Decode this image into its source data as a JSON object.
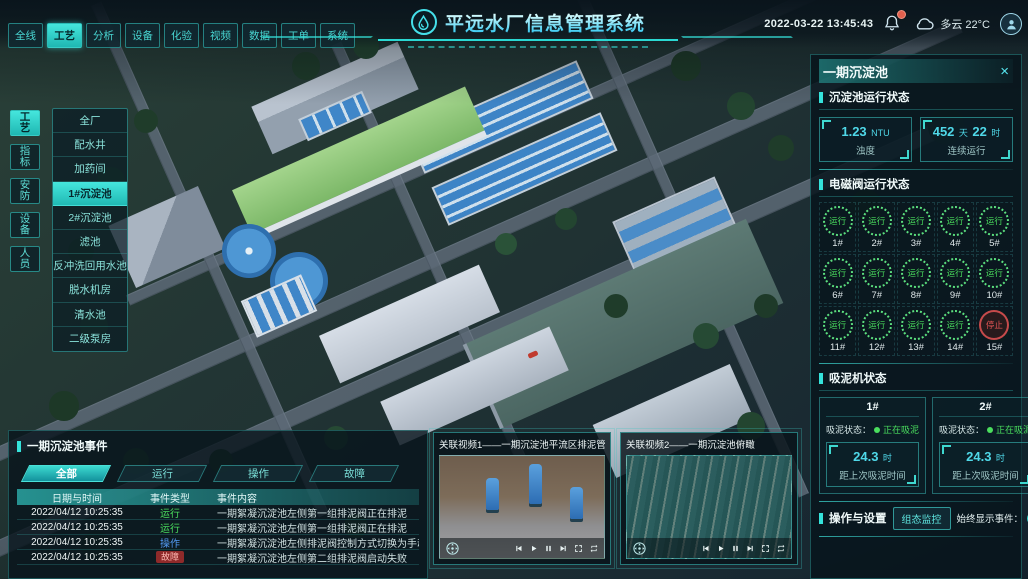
{
  "top_bar": {
    "title": "平远水厂信息管理系统",
    "datetime": "2022-03-22 13:45:43",
    "weather": "多云 22°C",
    "tabs": [
      {
        "label": "全线"
      },
      {
        "label": "工艺",
        "cls": "active"
      },
      {
        "label": "分析"
      },
      {
        "label": "设备"
      },
      {
        "label": "化验"
      },
      {
        "label": "视频"
      },
      {
        "label": "数据"
      },
      {
        "label": "工单"
      },
      {
        "label": "系统"
      }
    ]
  },
  "sidebar": {
    "tabs": [
      {
        "label": "工艺",
        "cls": "active"
      },
      {
        "label": "指标"
      },
      {
        "label": "安防"
      },
      {
        "label": "设备"
      },
      {
        "label": "人员"
      }
    ],
    "menu_items": [
      {
        "label": "全厂"
      },
      {
        "label": "配水井"
      },
      {
        "label": "加药间"
      },
      {
        "label": "1#沉淀池",
        "cls": "active"
      },
      {
        "label": "2#沉淀池"
      },
      {
        "label": "滤池"
      },
      {
        "label": "反冲洗回用水池"
      },
      {
        "label": "脱水机房"
      },
      {
        "label": "清水池"
      },
      {
        "label": "二级泵房"
      }
    ]
  },
  "right_panel": {
    "title": "一期沉淀池",
    "close": "×",
    "pool_status": {
      "title": "沉淀池运行状态",
      "stats": [
        {
          "value": "1.23",
          "unit": "NTU",
          "label": "浊度"
        },
        {
          "value": "452",
          "unit": "天",
          "value2": "22",
          "unit2": "时",
          "label": "连续运行"
        }
      ]
    },
    "valves": {
      "title": "电磁阀运行状态",
      "items": [
        {
          "id": "1#",
          "status": "运行",
          "cls": "run"
        },
        {
          "id": "2#",
          "status": "运行",
          "cls": "run"
        },
        {
          "id": "3#",
          "status": "运行",
          "cls": "run"
        },
        {
          "id": "4#",
          "status": "运行",
          "cls": "run"
        },
        {
          "id": "5#",
          "status": "运行",
          "cls": "run"
        },
        {
          "id": "6#",
          "status": "运行",
          "cls": "run"
        },
        {
          "id": "7#",
          "status": "运行",
          "cls": "run"
        },
        {
          "id": "8#",
          "status": "运行",
          "cls": "run"
        },
        {
          "id": "9#",
          "status": "运行",
          "cls": "run"
        },
        {
          "id": "10#",
          "status": "运行",
          "cls": "run"
        },
        {
          "id": "11#",
          "status": "运行",
          "cls": "run"
        },
        {
          "id": "12#",
          "status": "运行",
          "cls": "run"
        },
        {
          "id": "13#",
          "status": "运行",
          "cls": "run"
        },
        {
          "id": "14#",
          "status": "运行",
          "cls": "run"
        },
        {
          "id": "15#",
          "status": "停止",
          "cls": "stop"
        }
      ]
    },
    "scrapers": {
      "title": "吸泥机状态",
      "items": [
        {
          "id": "1#",
          "status_label": "吸泥状态：",
          "status": "正在吸泥",
          "value": "24.3",
          "unit": "时",
          "label": "距上次吸泥时间"
        },
        {
          "id": "2#",
          "status_label": "吸泥状态：",
          "status": "正在吸泥",
          "value": "24.3",
          "unit": "时",
          "label": "距上次吸泥时间"
        }
      ]
    },
    "operations": {
      "title": "操作与设置",
      "button_label": "组态监控",
      "toggle_label": "始终显示事件：",
      "toggle_on": true
    }
  },
  "events_panel": {
    "title": "一期沉淀池事件",
    "tabs": [
      {
        "label": "全部",
        "cls": "active"
      },
      {
        "label": "运行"
      },
      {
        "label": "操作"
      },
      {
        "label": "故障"
      }
    ],
    "columns": [
      "日期与时间",
      "事件类型",
      "事件内容"
    ],
    "rows": [
      {
        "time": "2022/04/12 10:25:35",
        "type": "运行",
        "type_cls": "t-run",
        "content": "一期絮凝沉淀池左侧第一组排泥阀正在排泥"
      },
      {
        "time": "2022/04/12 10:25:35",
        "type": "运行",
        "type_cls": "t-run",
        "content": "一期絮凝沉淀池左侧第一组排泥阀正在排泥"
      },
      {
        "time": "2022/04/12 10:25:35",
        "type": "操作",
        "type_cls": "t-op",
        "content": "一期絮凝沉淀池左侧排泥阀控制方式切换为手动"
      },
      {
        "time": "2022/04/12 10:25:35",
        "type": "故障",
        "type_cls": "t-fault",
        "content": "一期絮凝沉淀池左侧第二组排泥阀启动失败"
      }
    ]
  },
  "videos": [
    {
      "title": "关联视频1——一期沉淀池平流区排泥管廊",
      "thumb_cls": "thumb-pumps"
    },
    {
      "title": "关联视频2——一期沉淀池俯瞰",
      "thumb_cls": "thumb-lanes"
    }
  ],
  "colors": {
    "accent": "#35e3db",
    "run_green": "#4ade5e",
    "stop_red": "#e25454",
    "operate_blue": "#539bf5"
  }
}
